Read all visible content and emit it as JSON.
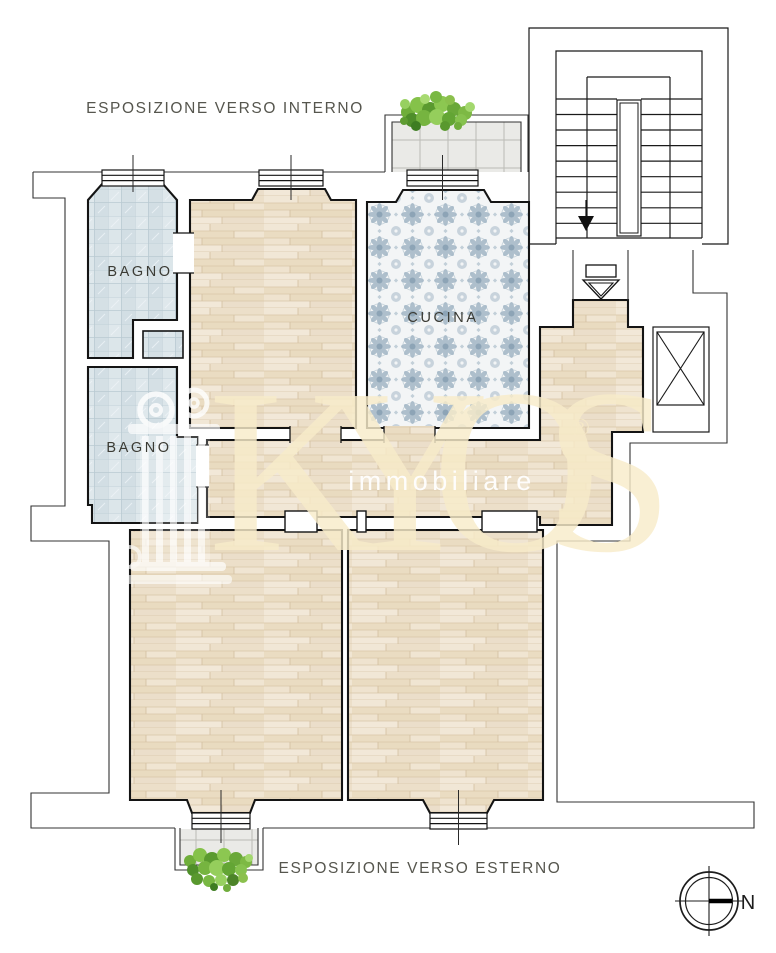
{
  "annotations": {
    "top": "ESPOSIZIONE VERSO INTERNO",
    "bottom": "ESPOSIZIONE VERSO ESTERNO"
  },
  "rooms": {
    "bathroom_top": "BAGNO",
    "bathroom_bottom": "BAGNO",
    "kitchen": "CUCINA"
  },
  "watermark": {
    "brand": "KYOS",
    "registered": "®",
    "subtitle": "immobiliare"
  },
  "compass": {
    "north_label": "N"
  },
  "colors": {
    "wood_floor": "#eee2cf",
    "bath_tile": "#d8e2e7",
    "kitchen_tile_accent": "#a6b9c8",
    "balcony_tile": "#e7e7e4",
    "walls": "#141414",
    "room_label_text": "#3b3b34",
    "annotation_text": "#56564e",
    "watermark_cream": "#f8ecca",
    "plant_green": "#76b440"
  }
}
